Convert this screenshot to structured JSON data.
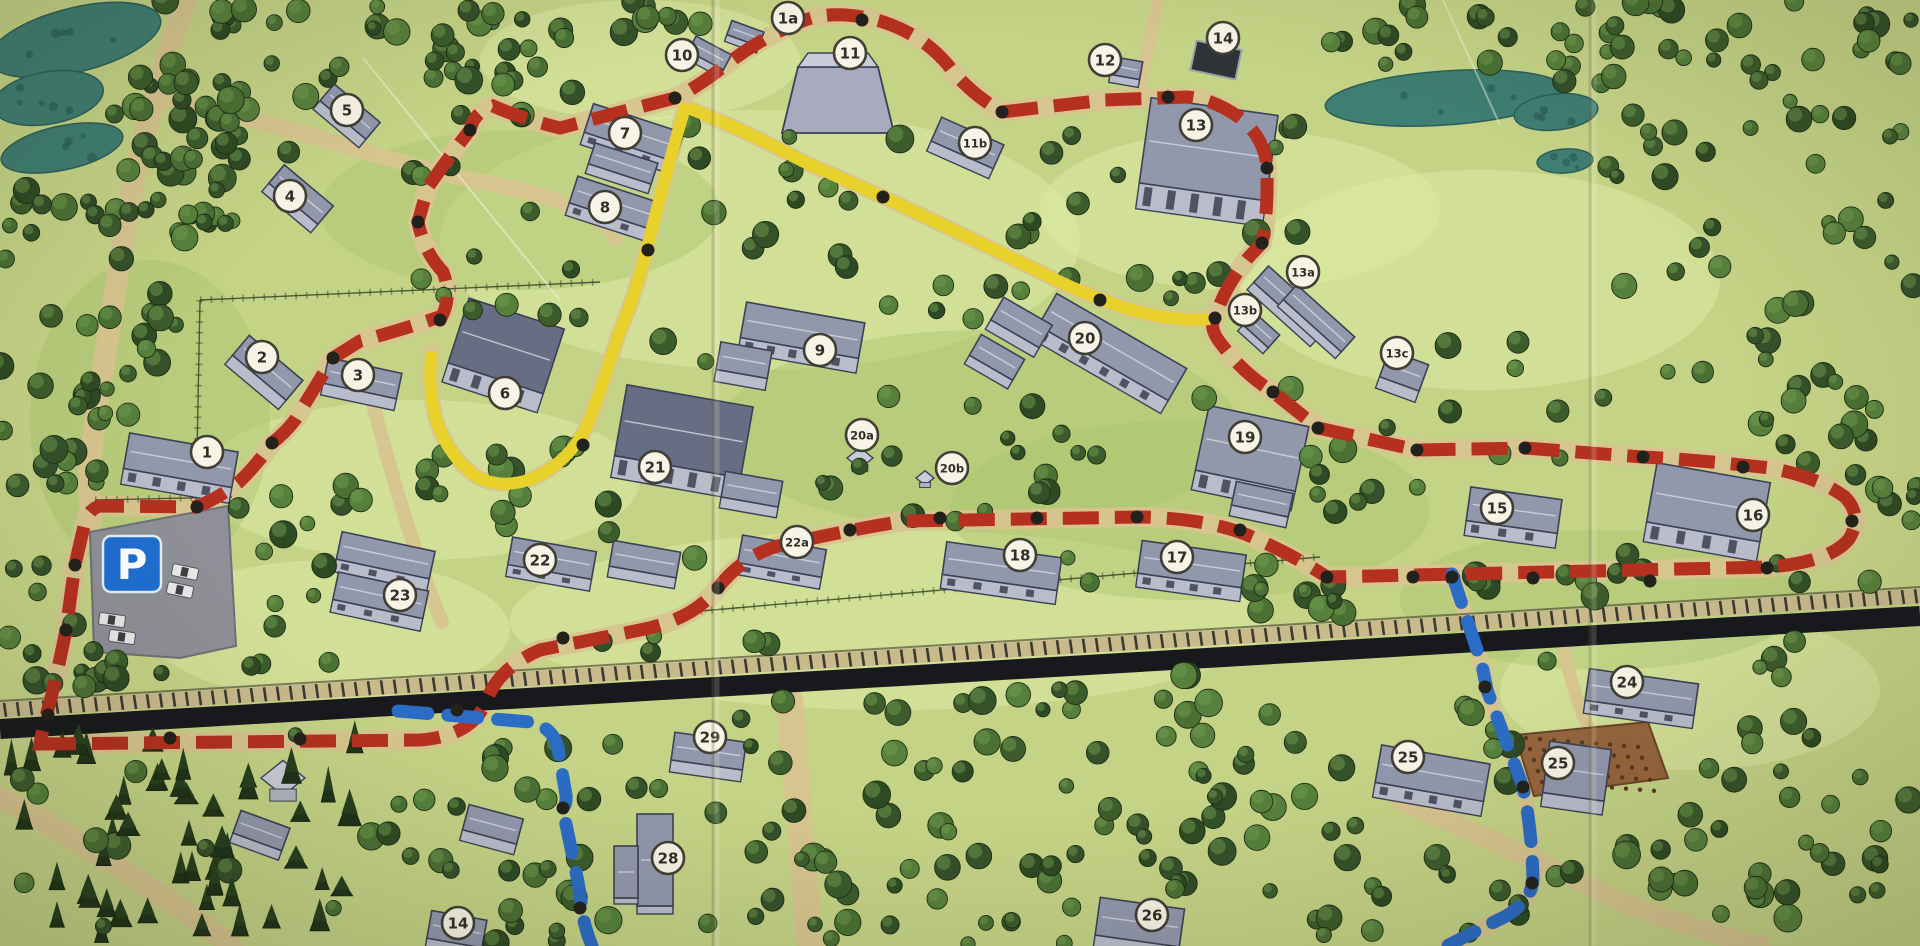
{
  "map": {
    "kind": "illustrated-park-site-map",
    "parking_label": "P",
    "colors": {
      "ground": "#c5d386",
      "ground_light": "#dde9a4",
      "ground_dark": "#a6c46e",
      "water": "#3f7e72",
      "road": "#d8c48f",
      "railway": "#17191d",
      "railway_ties": "#c9ba8c",
      "route_red": "#b5301e",
      "route_yellow": "#e9d12b",
      "route_blue": "#2b6cc4",
      "node": "#23211b",
      "marker_fill": "#f7f3e6",
      "marker_stroke": "#403f35",
      "building_wall": "#d6d8e2",
      "building_roof": "#9298ac",
      "parking_sign_blue": "#1e6fd2"
    },
    "routes": [
      {
        "name": "red-trail",
        "color": "#b5301e",
        "style": "dashed"
      },
      {
        "name": "yellow-trail",
        "color": "#e9d12b",
        "style": "solid"
      },
      {
        "name": "blue-trail",
        "color": "#2b6cc4",
        "style": "dashed"
      }
    ],
    "markers": [
      {
        "label": "1",
        "x": 207,
        "y": 452
      },
      {
        "label": "1a",
        "x": 788,
        "y": 18
      },
      {
        "label": "2",
        "x": 262,
        "y": 357
      },
      {
        "label": "3",
        "x": 358,
        "y": 375
      },
      {
        "label": "4",
        "x": 290,
        "y": 196
      },
      {
        "label": "5",
        "x": 347,
        "y": 110
      },
      {
        "label": "6",
        "x": 505,
        "y": 393
      },
      {
        "label": "7",
        "x": 625,
        "y": 133
      },
      {
        "label": "8",
        "x": 605,
        "y": 207
      },
      {
        "label": "9",
        "x": 820,
        "y": 350
      },
      {
        "label": "10",
        "x": 682,
        "y": 55
      },
      {
        "label": "11",
        "x": 850,
        "y": 53
      },
      {
        "label": "11b",
        "x": 975,
        "y": 143
      },
      {
        "label": "12",
        "x": 1105,
        "y": 60
      },
      {
        "label": "13",
        "x": 1196,
        "y": 125
      },
      {
        "label": "13a",
        "x": 1303,
        "y": 272
      },
      {
        "label": "13b",
        "x": 1245,
        "y": 310
      },
      {
        "label": "13c",
        "x": 1397,
        "y": 353
      },
      {
        "label": "14",
        "x": 1223,
        "y": 38
      },
      {
        "label": "15",
        "x": 1497,
        "y": 508
      },
      {
        "label": "16",
        "x": 1753,
        "y": 515
      },
      {
        "label": "17",
        "x": 1177,
        "y": 557
      },
      {
        "label": "18",
        "x": 1020,
        "y": 555
      },
      {
        "label": "19",
        "x": 1245,
        "y": 437
      },
      {
        "label": "20",
        "x": 1085,
        "y": 338
      },
      {
        "label": "20a",
        "x": 862,
        "y": 435
      },
      {
        "label": "20b",
        "x": 952,
        "y": 468
      },
      {
        "label": "21",
        "x": 655,
        "y": 467
      },
      {
        "label": "22",
        "x": 540,
        "y": 560
      },
      {
        "label": "22a",
        "x": 797,
        "y": 542
      },
      {
        "label": "23",
        "x": 400,
        "y": 595
      },
      {
        "label": "24",
        "x": 1627,
        "y": 682
      },
      {
        "label": "25",
        "x": 1408,
        "y": 757
      },
      {
        "label": "25",
        "x": 1558,
        "y": 763
      },
      {
        "label": "26",
        "x": 1152,
        "y": 915
      },
      {
        "label": "28",
        "x": 668,
        "y": 858
      },
      {
        "label": "29",
        "x": 710,
        "y": 737
      },
      {
        "label": "14",
        "x": 458,
        "y": 923
      }
    ]
  }
}
